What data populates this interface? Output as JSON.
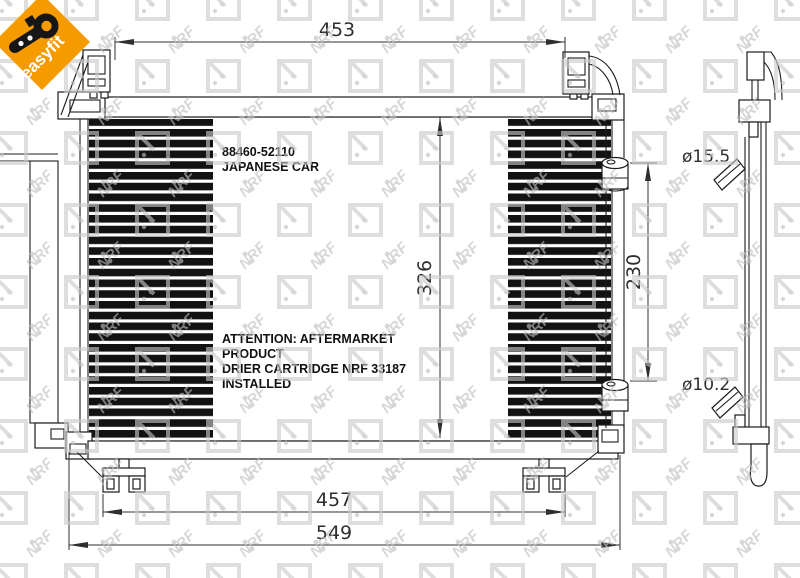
{
  "page": {
    "background": "#ffffff"
  },
  "watermark": {
    "text": "NRF",
    "color": "#bfbfbf"
  },
  "logo": {
    "label": "easyfit",
    "background_color": "#f59b00",
    "icon": "wrench-key-icon"
  },
  "drawing": {
    "part_number": "88460-52110",
    "part_type": "JAPANESE CAR",
    "attention": {
      "line1": "ATTENTION: AFTERMARKET",
      "line2": "PRODUCT",
      "line3": "DRIER CARTRIDGE NRF 33187",
      "line4": "INSTALLED"
    },
    "dimensions": {
      "top_width": "453",
      "core_height": "326",
      "receiver_drier_length": "230",
      "mounting_feet_width": "457",
      "overall_width": "549",
      "inlet_diameter": "ø15.5",
      "outlet_diameter": "ø10.2"
    }
  }
}
